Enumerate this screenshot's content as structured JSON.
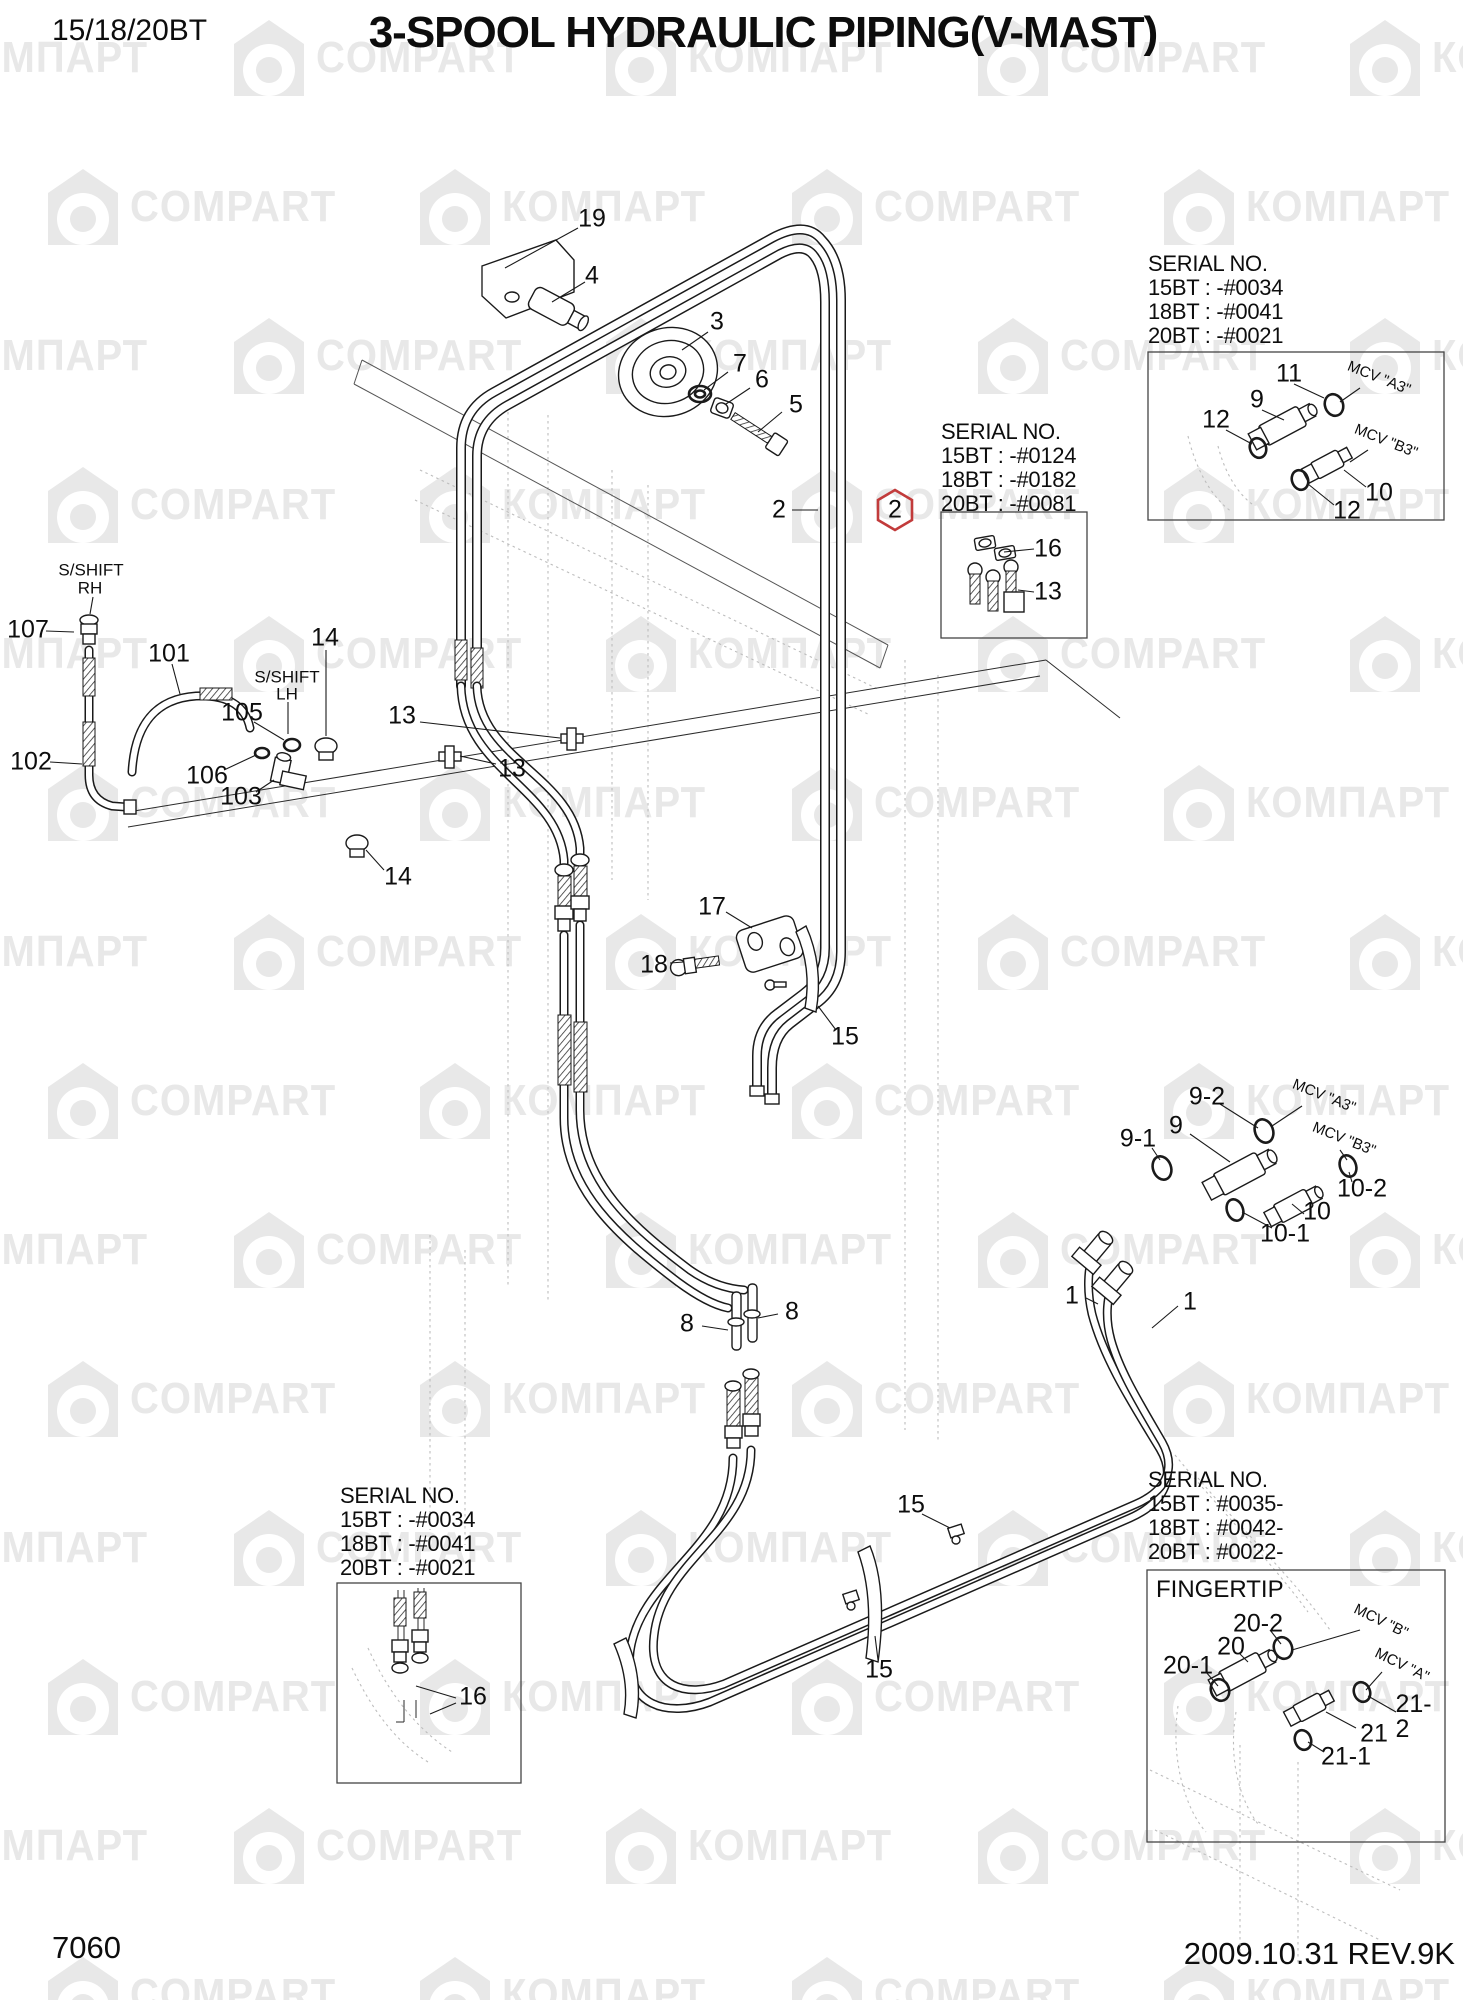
{
  "header": {
    "model": "15/18/20BT",
    "title": "3-SPOOL HYDRAULIC PIPING(V-MAST)"
  },
  "footer": {
    "drawing_no": "7060",
    "revision": "2009.10.31 REV.9K"
  },
  "watermark": {
    "cyrillic": "КОМПАРТ",
    "latin": "COMPART",
    "color": "#e8e8e8"
  },
  "highlight": {
    "part": "2",
    "color": "#c23b3b"
  },
  "fingertip": {
    "label": "FINGERTIP"
  },
  "serial_boxes": [
    {
      "x": 1148,
      "y": 252,
      "lines": [
        "SERIAL NO.",
        "15BT : -#0034",
        "18BT : -#0041",
        "20BT : -#0021"
      ]
    },
    {
      "x": 941,
      "y": 420,
      "lines": [
        "SERIAL NO.",
        "15BT : -#0124",
        "18BT : -#0182",
        "20BT : -#0081"
      ]
    },
    {
      "x": 1148,
      "y": 1468,
      "lines": [
        "SERIAL NO.",
        "15BT : #0035-",
        "18BT : #0042-",
        "20BT : #0022-"
      ]
    },
    {
      "x": 340,
      "y": 1484,
      "lines": [
        "SERIAL NO.",
        "15BT : -#0034",
        "18BT : -#0041",
        "20BT : -#0021"
      ]
    }
  ],
  "callouts": [
    {
      "text": "19",
      "x": 592,
      "y": 219
    },
    {
      "text": "4",
      "x": 592,
      "y": 276
    },
    {
      "text": "3",
      "x": 717,
      "y": 322
    },
    {
      "text": "7",
      "x": 740,
      "y": 364
    },
    {
      "text": "6",
      "x": 762,
      "y": 380
    },
    {
      "text": "5",
      "x": 796,
      "y": 405
    },
    {
      "text": "2",
      "x": 779,
      "y": 510
    },
    {
      "text": "2",
      "x": 895,
      "y": 510,
      "hex": true
    },
    {
      "text": "16",
      "x": 1048,
      "y": 549
    },
    {
      "text": "13",
      "x": 1048,
      "y": 592
    },
    {
      "text": "11",
      "x": 1289,
      "y": 374
    },
    {
      "text": "9",
      "x": 1257,
      "y": 400
    },
    {
      "text": "12",
      "x": 1216,
      "y": 420
    },
    {
      "text": "10",
      "x": 1379,
      "y": 493
    },
    {
      "text": "12",
      "x": 1347,
      "y": 511
    },
    {
      "text": "107",
      "x": 28,
      "y": 630
    },
    {
      "text": "101",
      "x": 169,
      "y": 654
    },
    {
      "text": "14",
      "x": 325,
      "y": 638
    },
    {
      "text": "105",
      "x": 242,
      "y": 713
    },
    {
      "text": "106",
      "x": 207,
      "y": 776
    },
    {
      "text": "103",
      "x": 241,
      "y": 797
    },
    {
      "text": "102",
      "x": 31,
      "y": 762
    },
    {
      "text": "13",
      "x": 402,
      "y": 716
    },
    {
      "text": "13",
      "x": 512,
      "y": 769
    },
    {
      "text": "14",
      "x": 398,
      "y": 877
    },
    {
      "text": "17",
      "x": 712,
      "y": 907
    },
    {
      "text": "18",
      "x": 654,
      "y": 965
    },
    {
      "text": "15",
      "x": 845,
      "y": 1037
    },
    {
      "text": "9-2",
      "x": 1207,
      "y": 1097
    },
    {
      "text": "9",
      "x": 1176,
      "y": 1126
    },
    {
      "text": "9-1",
      "x": 1138,
      "y": 1139
    },
    {
      "text": "10-2",
      "x": 1362,
      "y": 1189
    },
    {
      "text": "10",
      "x": 1317,
      "y": 1212
    },
    {
      "text": "10-1",
      "x": 1285,
      "y": 1234
    },
    {
      "text": "1",
      "x": 1072,
      "y": 1296
    },
    {
      "text": "1",
      "x": 1190,
      "y": 1302
    },
    {
      "text": "8",
      "x": 687,
      "y": 1324
    },
    {
      "text": "8",
      "x": 792,
      "y": 1312
    },
    {
      "text": "15",
      "x": 911,
      "y": 1505
    },
    {
      "text": "15",
      "x": 879,
      "y": 1670
    },
    {
      "text": "16",
      "x": 473,
      "y": 1697
    },
    {
      "text": "20-2",
      "x": 1258,
      "y": 1624
    },
    {
      "text": "20",
      "x": 1231,
      "y": 1647
    },
    {
      "text": "20-1",
      "x": 1188,
      "y": 1666
    },
    {
      "text": "21-2",
      "x": 1418,
      "y": 1717
    },
    {
      "text": "21",
      "x": 1374,
      "y": 1734
    },
    {
      "text": "21-1",
      "x": 1346,
      "y": 1757
    }
  ],
  "annotations": [
    {
      "text": "S/SHIFT",
      "x": 91,
      "y": 570,
      "cls": "shift"
    },
    {
      "text": "RH",
      "x": 90,
      "y": 588,
      "cls": "shift"
    },
    {
      "text": "S/SHIFT",
      "x": 287,
      "y": 677,
      "cls": "shift"
    },
    {
      "text": "LH",
      "x": 287,
      "y": 694,
      "cls": "shift"
    },
    {
      "text": "MCV \"A3\"",
      "x": 1379,
      "y": 378,
      "rotate": 22,
      "cls": "mcv"
    },
    {
      "text": "MCV \"B3\"",
      "x": 1386,
      "y": 441,
      "rotate": 22,
      "cls": "mcv"
    },
    {
      "text": "MCV \"A3\"",
      "x": 1324,
      "y": 1096,
      "rotate": 22,
      "cls": "mcv"
    },
    {
      "text": "MCV \"B3\"",
      "x": 1344,
      "y": 1139,
      "rotate": 22,
      "cls": "mcv"
    },
    {
      "text": "MCV \"B\"",
      "x": 1381,
      "y": 1621,
      "rotate": 26,
      "cls": "mcv"
    },
    {
      "text": "MCV \"A\"",
      "x": 1402,
      "y": 1665,
      "rotate": 26,
      "cls": "mcv"
    }
  ]
}
